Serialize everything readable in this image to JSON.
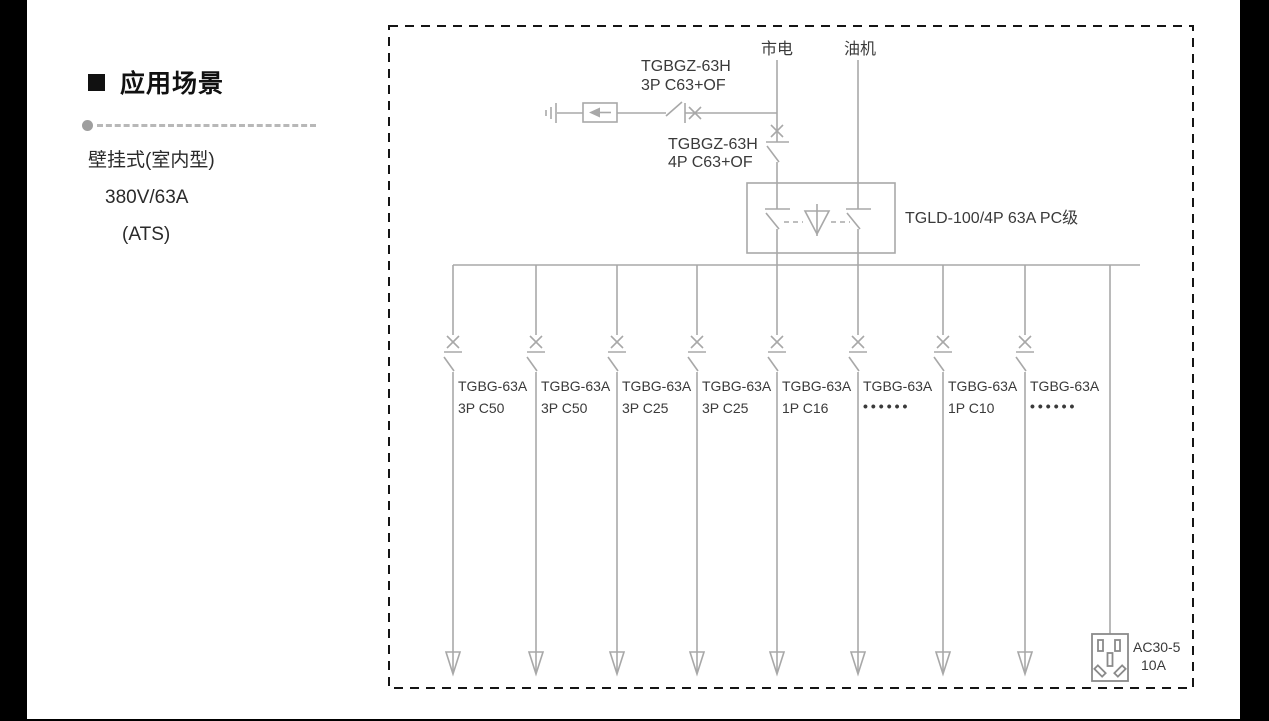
{
  "sidebar": {
    "title": "应用场景",
    "spec_line_1": "壁挂式(室内型)",
    "spec_line_2": "380V/63A",
    "spec_line_3": "(ATS)"
  },
  "diagram": {
    "colors": {
      "line_gray": "#a8a8a8",
      "text_dark": "#3a3a3a",
      "border_dash": "#151515",
      "background": "#ffffff",
      "letterbox": "#000000"
    },
    "sources": {
      "mains_label": "市电",
      "generator_label": "油机"
    },
    "spd_breaker": {
      "model": "TGBGZ-63H",
      "spec": "3P C63+OF"
    },
    "main_breaker": {
      "model": "TGBGZ-63H",
      "spec": "4P C63+OF"
    },
    "ats": {
      "label": "TGLD-100/4P 63A PC级"
    },
    "branches": [
      {
        "model": "TGBG-63A",
        "spec": "3P C50"
      },
      {
        "model": "TGBG-63A",
        "spec": "3P C50"
      },
      {
        "model": "TGBG-63A",
        "spec": "3P C25"
      },
      {
        "model": "TGBG-63A",
        "spec": "3P C25"
      },
      {
        "model": "TGBG-63A",
        "spec": "1P C16"
      },
      {
        "model": "TGBG-63A",
        "spec": "••••••"
      },
      {
        "model": "TGBG-63A",
        "spec": "1P C10"
      },
      {
        "model": "TGBG-63A",
        "spec": "••••••"
      }
    ],
    "socket": {
      "model": "AC30-5",
      "rating": "10A"
    }
  }
}
